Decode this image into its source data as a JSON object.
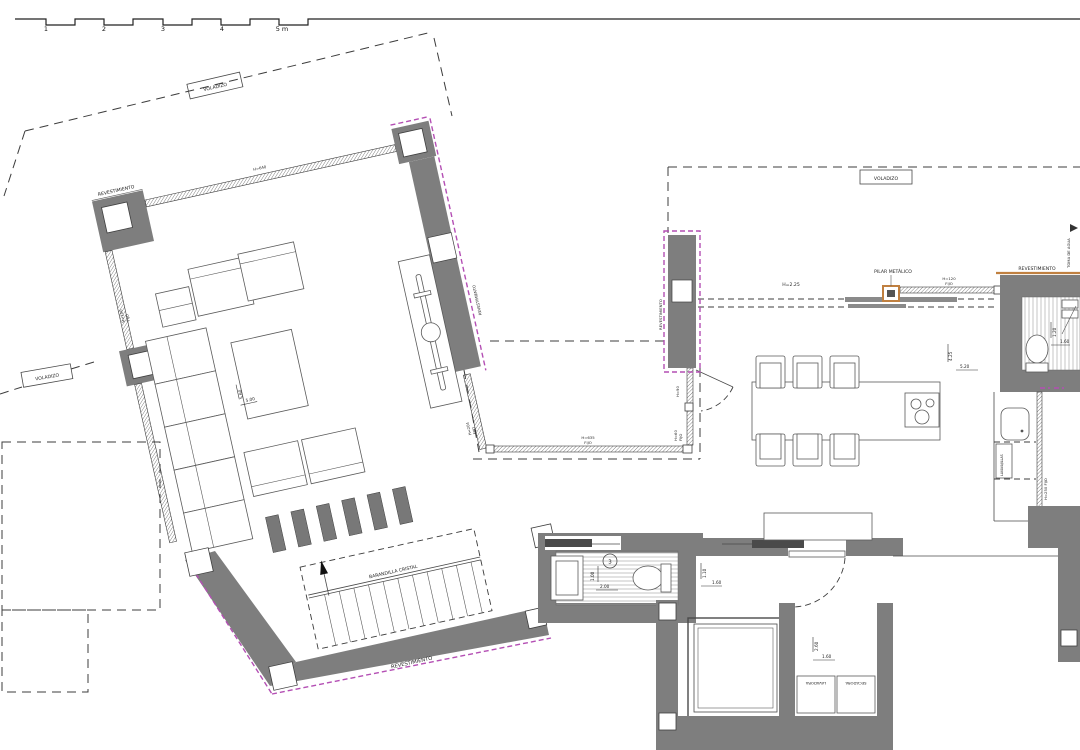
{
  "title": "floor-plan",
  "colors": {
    "wall": "#7e7e7e",
    "accent_magenta": "#b44fb4",
    "accent_tan": "#c08040",
    "line": "#3c3c3c",
    "background": "#ffffff"
  },
  "scale_bar": {
    "ticks": [
      "1",
      "2",
      "3",
      "4",
      "5 m"
    ]
  },
  "labels": {
    "voladizo": "VOLADIZO",
    "revestimiento": "REVESTIMIENTO",
    "pilar_metalico": "PILAR METÁLICO",
    "toma_de_agua": "TOMA DE AGUA",
    "barandilla_cristal": "BARANDILLA CRISTAL",
    "lavadora": "LAVADORA",
    "secadora": "SECADORA",
    "lavavajillas": "LAVAVAJILLAS",
    "stair_number": "3",
    "headroom": "H=2.25"
  },
  "windows": {
    "top": "H=640",
    "left_l1": "H=100",
    "left_l2": "FIJO",
    "diag_l1": "H=204",
    "diag_l2": "FIJO",
    "bottom_l1": "H=635",
    "bottom_l2": "FIJO",
    "entry_upper": "H=90",
    "entry_lower_l1": "H=60",
    "entry_lower_l2": "FIJO",
    "kitchen_l1": "H=120",
    "kitchen_l2": "FIJO",
    "kitchen_side": "H=250 FIJO"
  },
  "dimensions": {
    "living_depth": "5.60",
    "living_width": "5.00",
    "kitchen_depth": "4.25",
    "kitchen_width": "5.20",
    "bath_depth": "1.00",
    "bath_width": "2.00",
    "hall_depth": "1.10",
    "hall_width": "1.60",
    "laundry_depth": "2.60",
    "laundry_width": "1.60",
    "wc_depth": "1.20",
    "wc_width": "1.60"
  }
}
